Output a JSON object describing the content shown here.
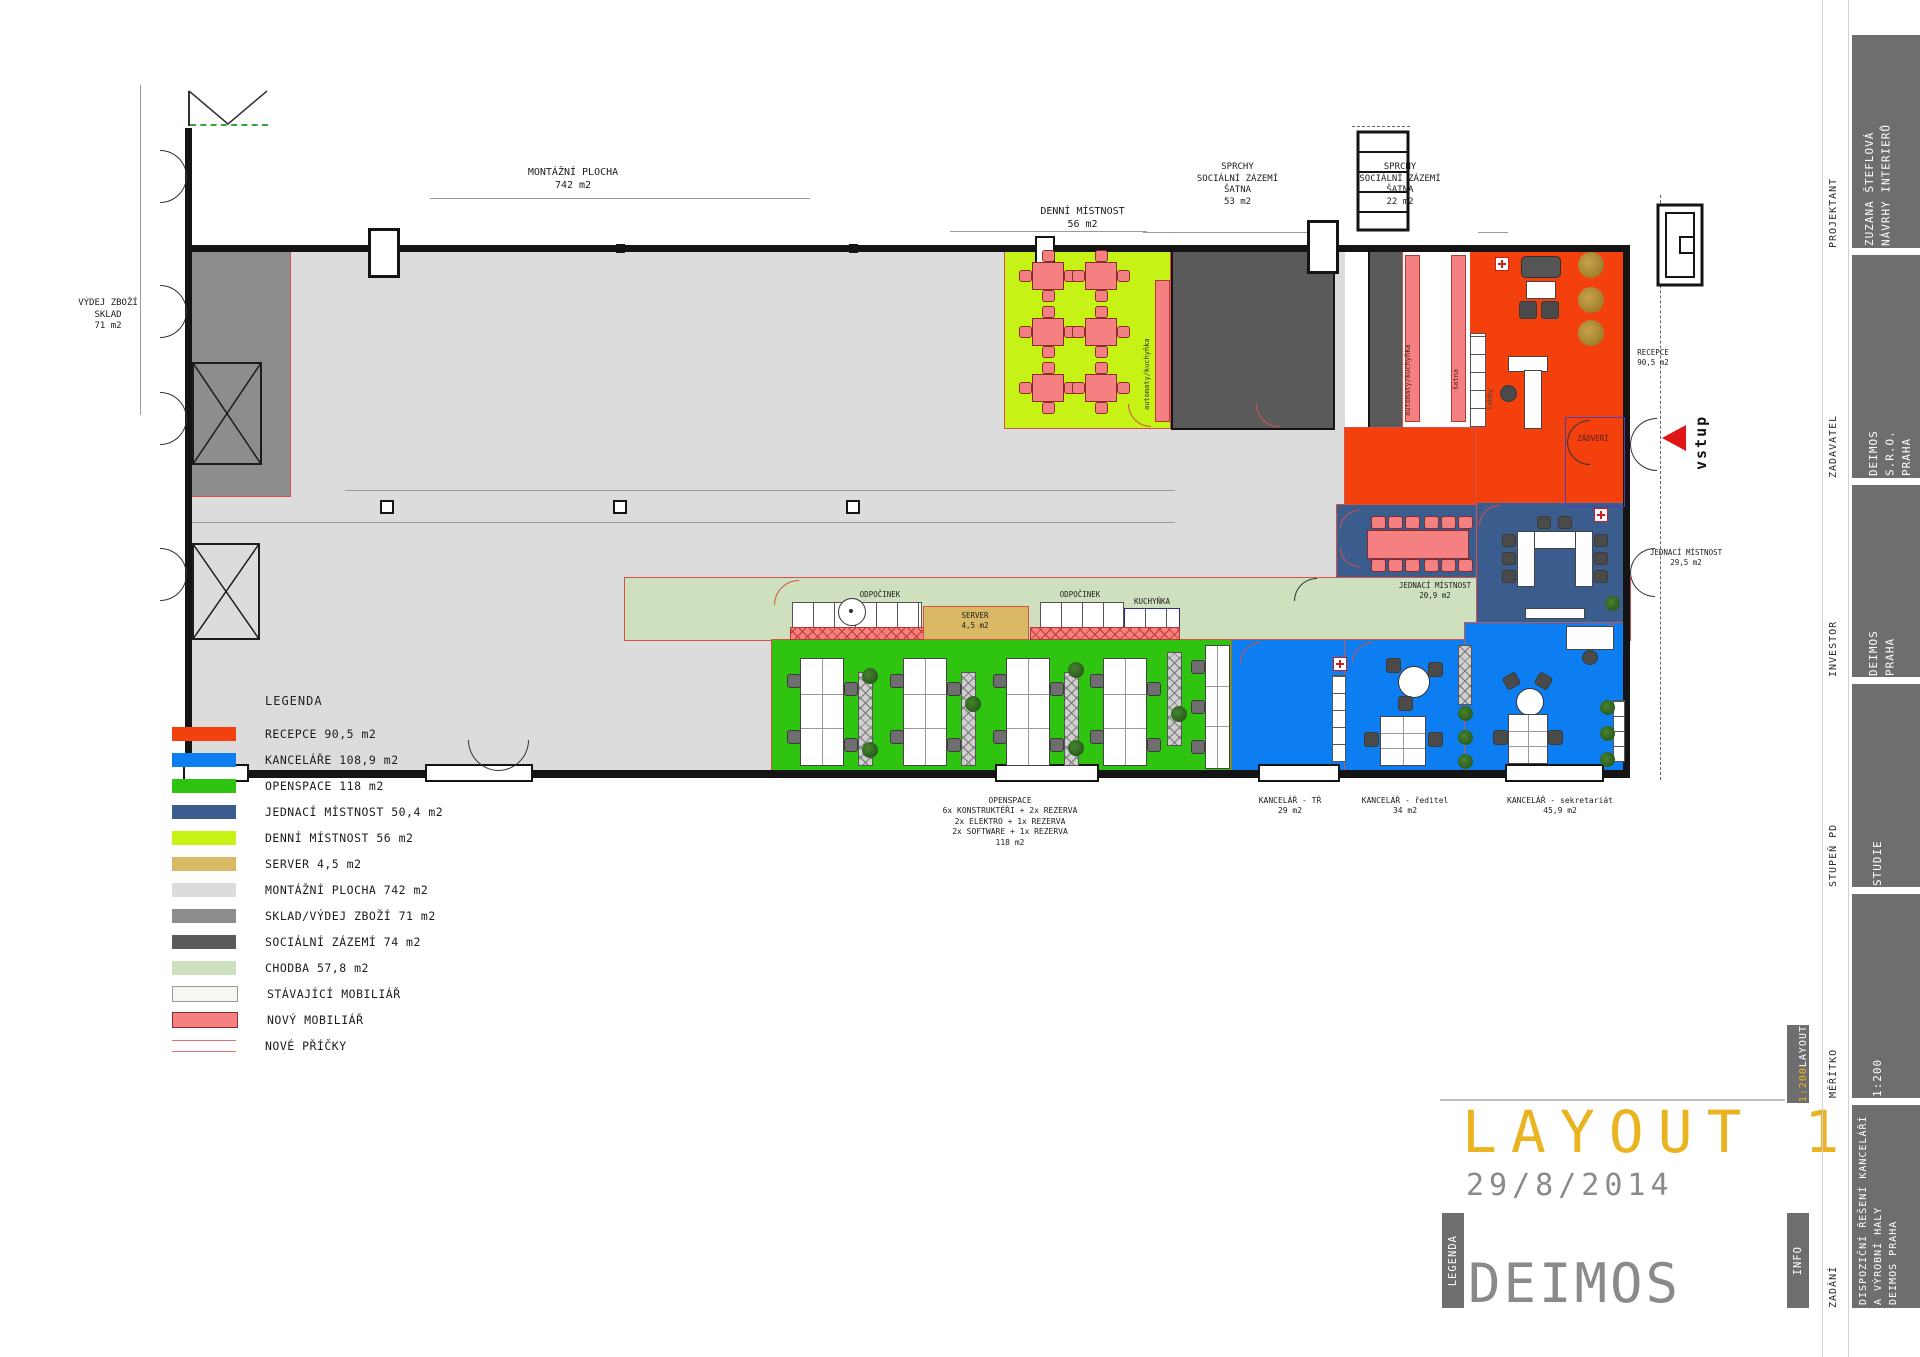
{
  "colors": {
    "recepce": "#f4400c",
    "kancelare": "#0d7df2",
    "openspace": "#2ec40f",
    "jednaci": "#3a5d8e",
    "denni": "#c6f216",
    "server": "#d9b964",
    "montazni": "#dcdcdc",
    "sklad": "#8d8d8d",
    "socialni": "#5a5a5a",
    "chodba": "#cfe0bf",
    "stavajici": "#f7f6f1",
    "novy": "#f58082",
    "pricky": "#e07070",
    "accent": "#eab421",
    "gray_text": "#8a8a8a",
    "bar": "#6e6e6e"
  },
  "legend": {
    "title": "LEGENDA",
    "items": [
      {
        "label": "RECEPCE 90,5 m2",
        "color": "#f4400c",
        "style": "fill"
      },
      {
        "label": "KANCELÁŘE 108,9 m2",
        "color": "#0d7df2",
        "style": "fill"
      },
      {
        "label": "OPENSPACE 118 m2",
        "color": "#2ec40f",
        "style": "fill"
      },
      {
        "label": "JEDNACÍ MÍSTNOST 50,4 m2",
        "color": "#3a5d8e",
        "style": "fill"
      },
      {
        "label": "DENNÍ MÍSTNOST 56 m2",
        "color": "#c6f216",
        "style": "fill"
      },
      {
        "label": "SERVER 4,5 m2",
        "color": "#d9b964",
        "style": "fill"
      },
      {
        "label": "MONTÁŽNÍ PLOCHA 742 m2",
        "color": "#dcdcdc",
        "style": "fill"
      },
      {
        "label": "SKLAD/VÝDEJ ZBOŽÍ 71 m2",
        "color": "#8d8d8d",
        "style": "fill"
      },
      {
        "label": "SOCIÁLNÍ ZÁZEMÍ 74 m2",
        "color": "#5a5a5a",
        "style": "fill"
      },
      {
        "label": "CHODBA 57,8 m2",
        "color": "#cfe0bf",
        "style": "fill"
      },
      {
        "label": "STÁVAJÍCÍ MOBILIÁŘ",
        "color": "#f7f6f1",
        "style": "outline"
      },
      {
        "label": "NOVÝ MOBILIÁŘ",
        "color": "#f58082",
        "style": "new"
      },
      {
        "label": "NOVÉ PŘÍČKY",
        "color": "#e07070",
        "style": "lines"
      }
    ]
  },
  "plan": {
    "labels": {
      "montazni": "MONTÁŽNÍ PLOCHA\n742 m2",
      "denni": "DENNÍ MÍSTNOST\n56 m2",
      "sprchy53": "SPRCHY\nSOCIÁLNÍ ZÁZEMÍ\nŠATNA\n53 m2",
      "sprchy22": "SPRCHY\nSOCIÁLNÍ ZÁZEMÍ\nŠATNA\n22 m2",
      "vydej": "VÝDEJ ZBOŽÍ\nSKLAD\n71 m2",
      "recepce": "RECEPCE\n90,5 m2",
      "vstup": "vstup",
      "zadveri": "ZÁDVEŘÍ",
      "jednaci295": "JEDNACÍ MÍSTNOST\n29,5 m2",
      "jednaci209": "JEDNACÍ MÍSTNOST\n20,9 m2",
      "odpocinek1": "ODPOČINEK",
      "odpocinek2": "ODPOČINEK",
      "server": "SERVER\n4,5 m2",
      "kuchynka": "KUCHYŇKA",
      "automaty1": "automaty/kuchyňka",
      "automaty2": "automaty/kuchyňka",
      "satna": "šatna",
      "lobby": "lobby",
      "openspace": "OPENSPACE\n6x KONSTRUKTÉŘI + 2x REZERVA\n2x ELEKTRO + 1x REZERVA\n2x SOFTWARE + 1x REZERVA\n118 m2",
      "kancelar_tr": "KANCELÁŘ - TŘ\n29 m2",
      "kancelar_reditel": "KANCELÁŘ - ředitel\n34 m2",
      "kancelar_sekretariat": "KANCELÁŘ - sekretariát\n45,9 m2"
    }
  },
  "titleblock": {
    "projektant_label": "PROJEKTANT",
    "projektant_value": "ZUZANA ŠTEFLOVÁ\nNÁVRHY INTERIERŮ",
    "zadavatel_label": "ZADAVATEL",
    "zadavatel_value": "DEIMOS S.R.O.\nPRAHA",
    "investor_label": "INVESTOR",
    "investor_value": "DEIMOS\nPRAHA",
    "stupen_label": "STUPEŇ PD",
    "stupen_value": "STUDIE",
    "meritko_label": "MĚŘÍTKO",
    "meritko_value": "1:200",
    "zadani_label": "ZADÁNÍ",
    "zadani_value": "DISPOZIČNÍ ŘEŠENÍ KANCELÁŘÍ\nA VÝROBNÍ HALY\nDEIMOS PRAHA",
    "layout_badge_word": "LAYOUT",
    "layout_badge_scale": "1:200",
    "info_badge": "INFO",
    "legenda_badge": "LEGENDA",
    "title": "LAYOUT 1",
    "date": "29/8/2014",
    "logo": "DEIMOS"
  }
}
